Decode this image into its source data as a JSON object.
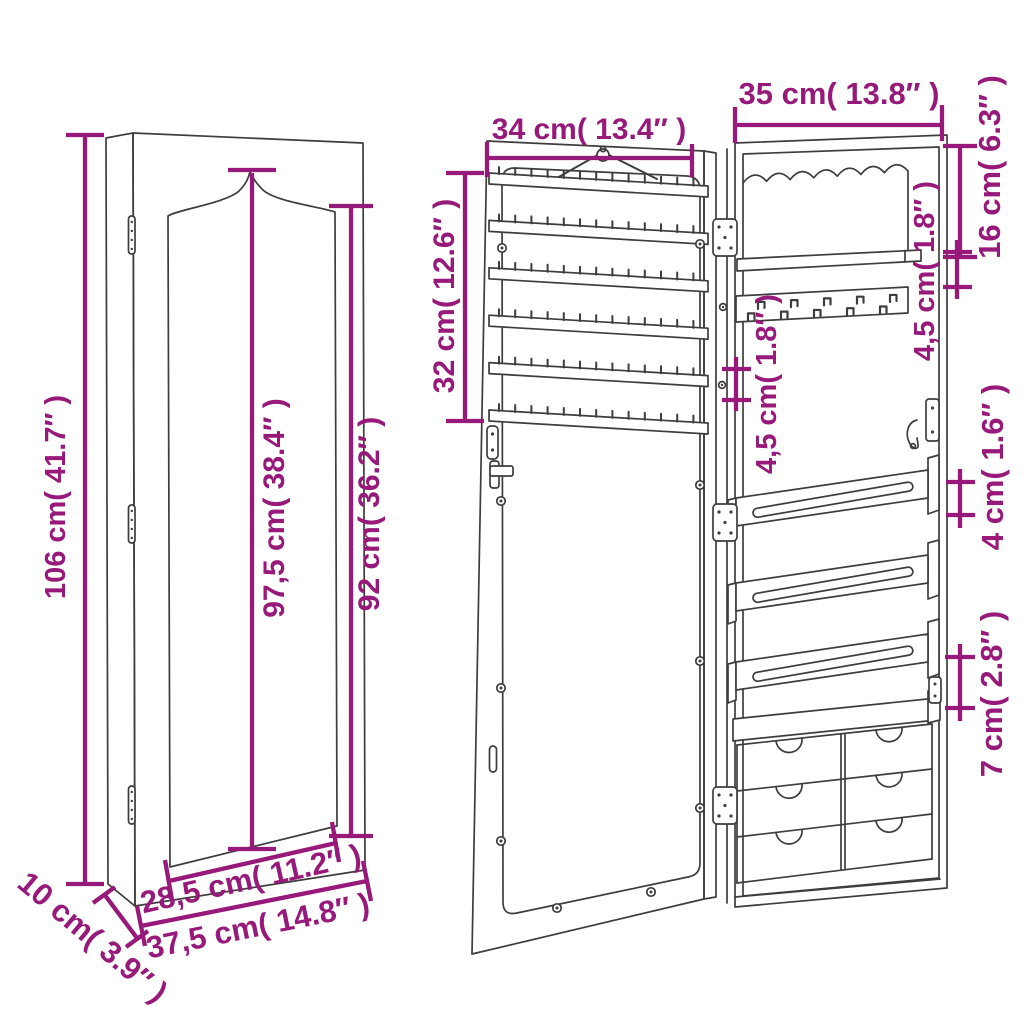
{
  "page": {
    "background": "#ffffff"
  },
  "colors": {
    "dimension_accent": "#971979",
    "drawing_line": "#3d3d3d"
  },
  "labels": {
    "closed_height": "106 cm( 41.7″ )",
    "mirror_height": "97,5 cm( 38.4″ )",
    "front_height": "92 cm( 36.2″ )",
    "mirror_width": "28,5 cm( 11.2″ )",
    "cabinet_width": "37,5 cm( 14.8″ )",
    "cabinet_depth": "10 cm( 3.9″ )",
    "door_width": "34 cm( 13.4″ )",
    "open_cabinet_width": "35 cm( 13.8″ )",
    "door_rack_height": "32 cm( 12.6″ )",
    "top_compartment_height": "16 cm( 6.3″ )",
    "shelf_gap": "4,5 cm( 1.8″ )",
    "strip_spacing": "4,5 cm( 1.8″ )",
    "rail_height": "4 cm( 1.6″ )",
    "drawer_gap": "7 cm( 2.8″ )"
  },
  "structure": {
    "earring_strips": 6,
    "earring_pins_per_strip": 13,
    "necklace_hooks": 10,
    "bracelet_rails": 3,
    "drawer_rows": 3,
    "drawer_columns": 2,
    "hinges": 3,
    "scallops": 7
  }
}
